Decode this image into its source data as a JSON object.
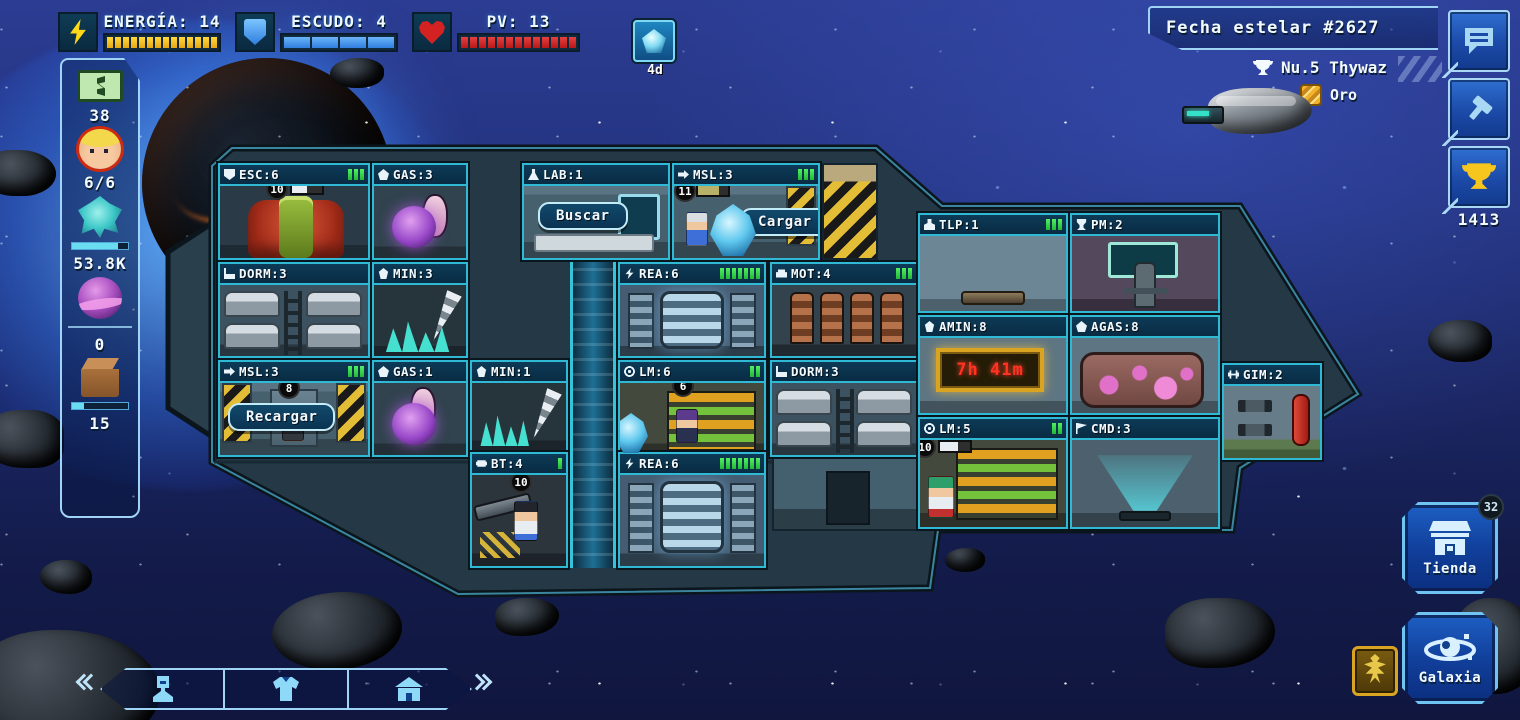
{
  "hud": {
    "energy": {
      "label": "ENERGÍA: 14",
      "segments": 14,
      "color": "#f2c319"
    },
    "shield": {
      "label": "ESCUDO: 4",
      "segments": 4,
      "color": "#3e8fe8"
    },
    "hp": {
      "label": "PV: 13",
      "segments": 13,
      "color": "#d42a2a"
    },
    "buff_label": "4d"
  },
  "header": {
    "stardate": "Fecha estelar #2627",
    "opponent_name": "Nu.5 Thywaz",
    "league": "Oro"
  },
  "side_buttons": {
    "trophy_score": "1413"
  },
  "resources": {
    "credits": "38",
    "crew": "6/6",
    "minerals": "53.8K",
    "gas": "0",
    "items": "15"
  },
  "rooms": [
    {
      "label": "ESC:6",
      "icon": "shield",
      "bars": 3,
      "badge": "10"
    },
    {
      "label": "GAS:3",
      "icon": "gas",
      "bars": 0
    },
    {
      "label": "LAB:1",
      "icon": "flask",
      "bars": 0,
      "button": "Buscar"
    },
    {
      "label": "MSL:3",
      "icon": "missile",
      "bars": 3,
      "badge": "11",
      "button": "Cargar"
    },
    {
      "label": "DORM:3",
      "icon": "bed",
      "bars": 0
    },
    {
      "label": "MIN:3",
      "icon": "mineral",
      "bars": 0
    },
    {
      "label": "REA:6",
      "icon": "bolt",
      "bars": 7
    },
    {
      "label": "MOT:4",
      "icon": "engine",
      "bars": 3
    },
    {
      "label": "MSL:3",
      "icon": "missile",
      "bars": 3,
      "badge": "8",
      "button": "Recargar"
    },
    {
      "label": "GAS:1",
      "icon": "gas",
      "bars": 0
    },
    {
      "label": "MIN:1",
      "icon": "mineral",
      "bars": 0
    },
    {
      "label": "LM:6",
      "icon": "laser",
      "bars": 2,
      "badge": "6"
    },
    {
      "label": "DORM:3",
      "icon": "bed",
      "bars": 0
    },
    {
      "label": "BT:4",
      "icon": "battery",
      "bars": 1,
      "badge": "10"
    },
    {
      "label": "REA:6",
      "icon": "bolt",
      "bars": 7
    },
    {
      "label": "TLP:1",
      "icon": "person",
      "bars": 3
    },
    {
      "label": "PM:2",
      "icon": "trophy",
      "bars": 0
    },
    {
      "label": "AMIN:8",
      "icon": "mineral",
      "bars": 0,
      "timer": "7h 41m"
    },
    {
      "label": "AGAS:8",
      "icon": "gas",
      "bars": 0
    },
    {
      "label": "LM:5",
      "icon": "laser",
      "bars": 2,
      "badge": "10"
    },
    {
      "label": "CMD:3",
      "icon": "flag",
      "bars": 0
    },
    {
      "label": "GIM:2",
      "icon": "dumbbell",
      "bars": 0
    }
  ],
  "corner": {
    "shop_label": "Tienda",
    "shop_badge": "32",
    "galaxy_label": "Galaxia"
  }
}
